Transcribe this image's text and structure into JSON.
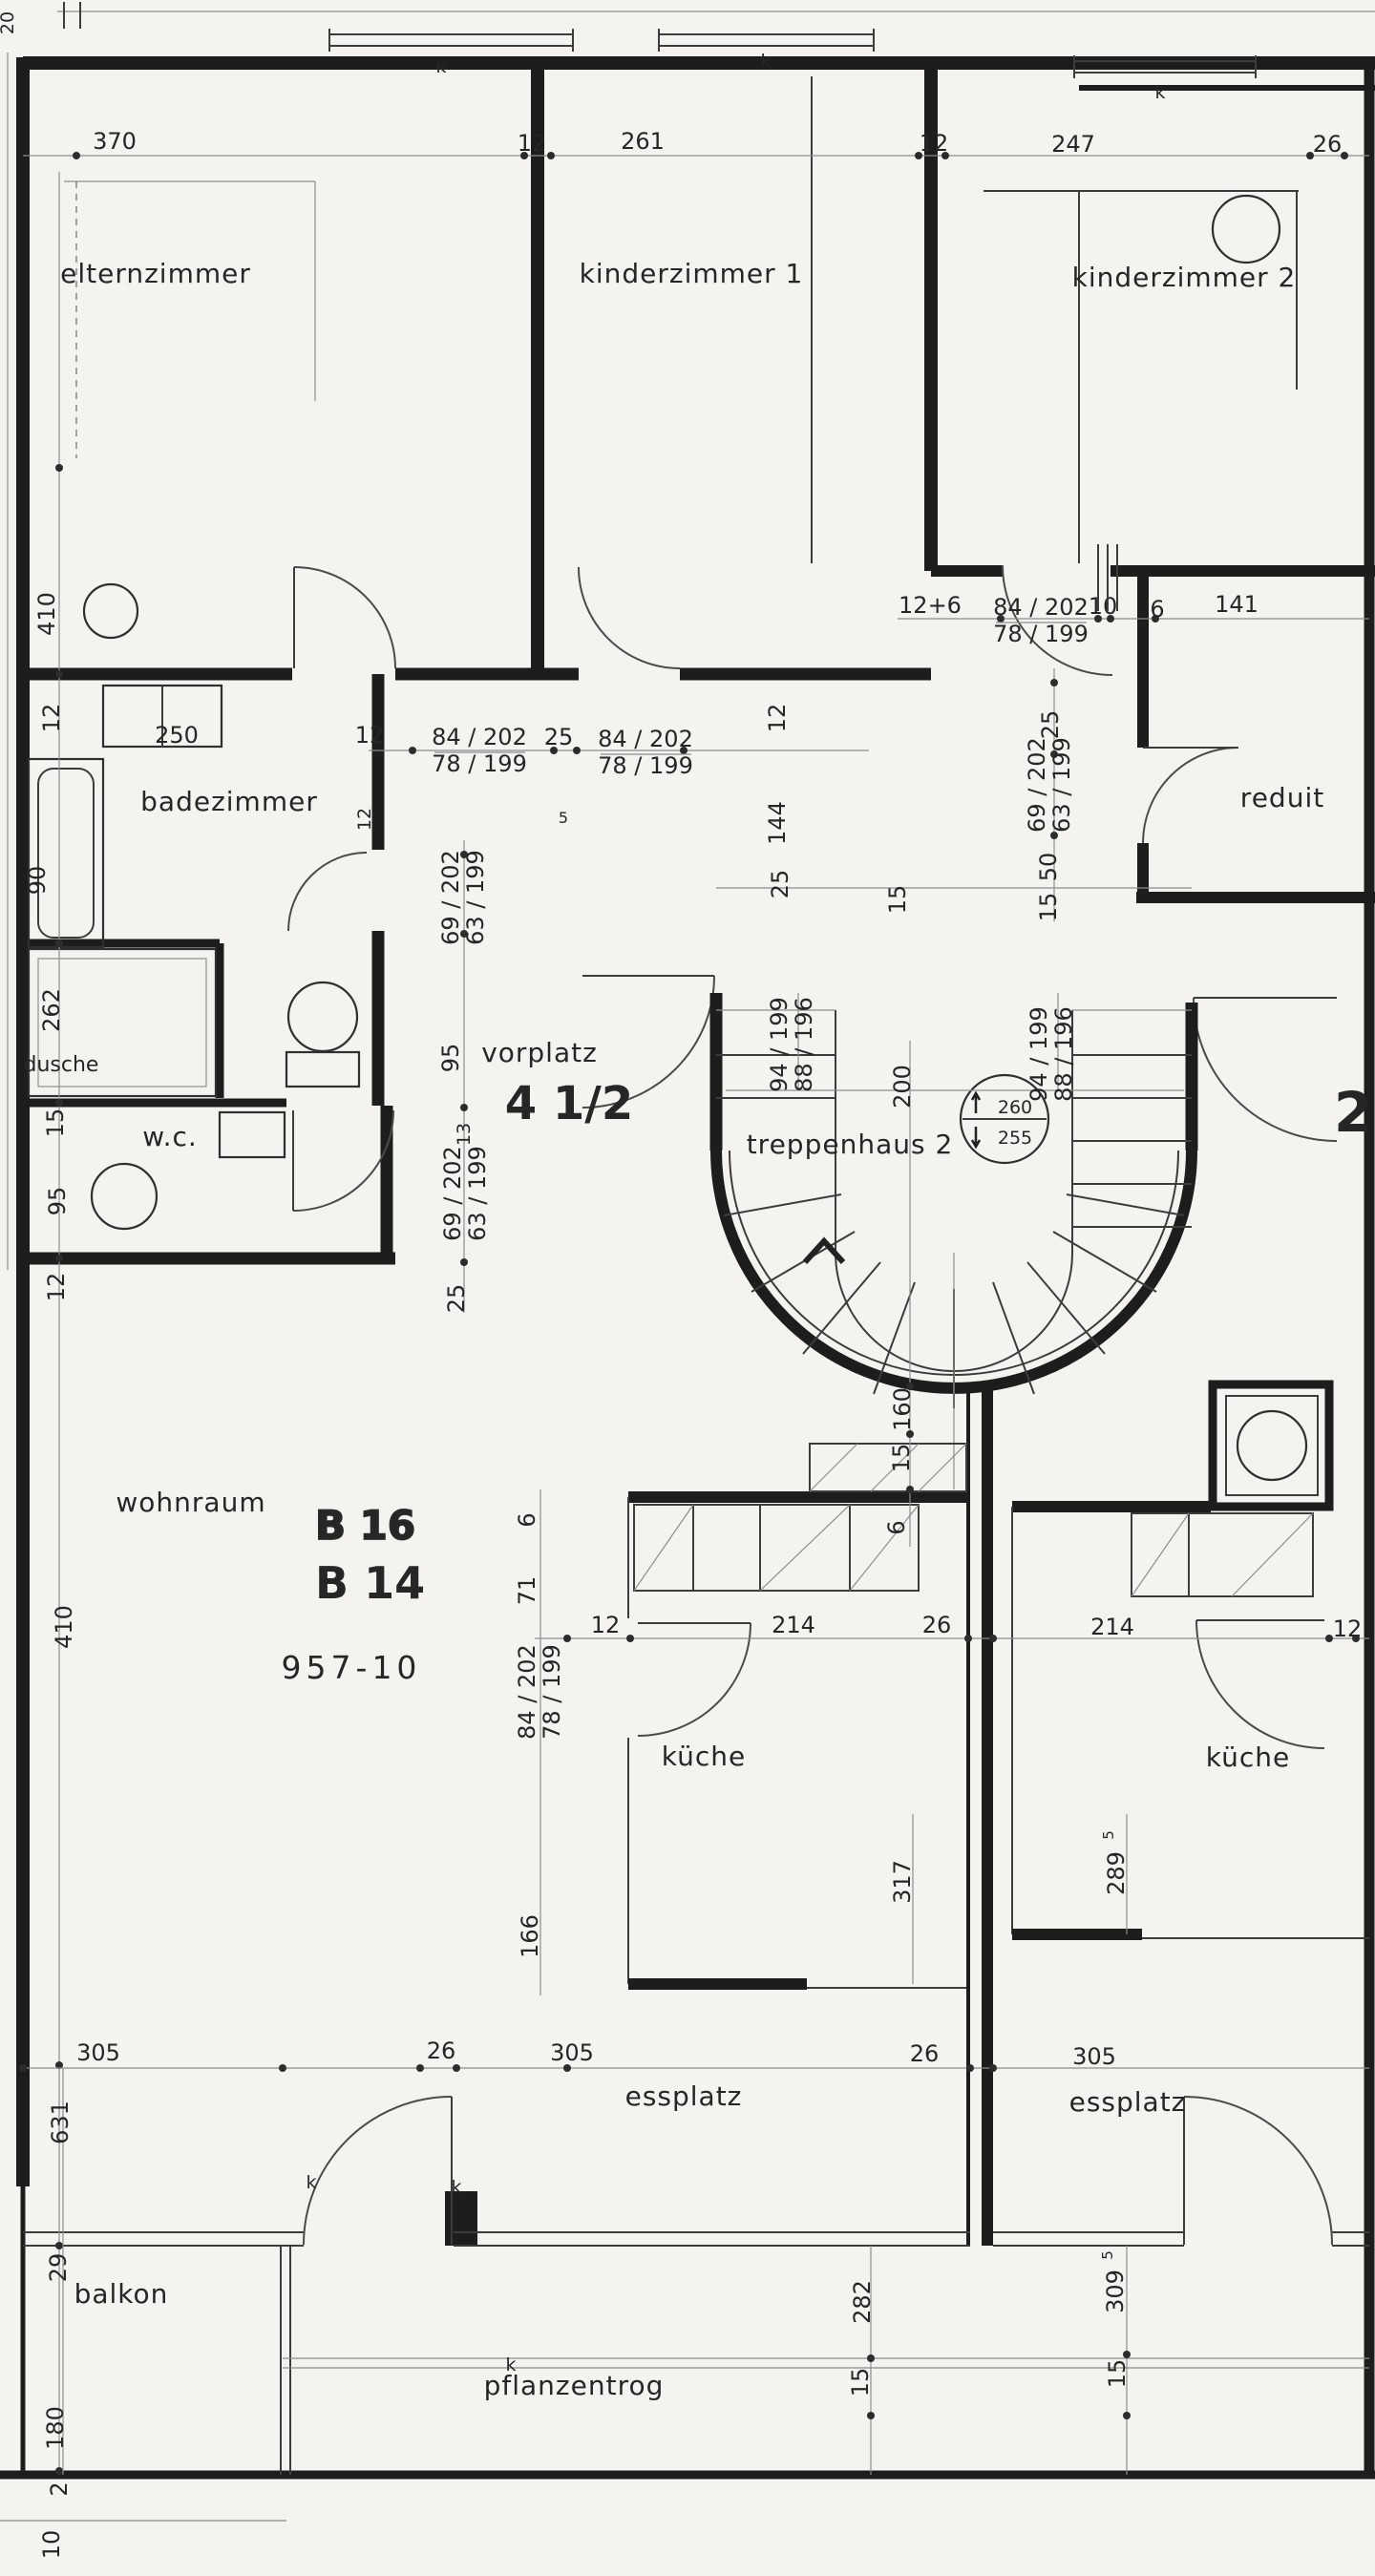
{
  "labels": {
    "rooms": {
      "elternzimmer": "elternzimmer",
      "kinderzimmer1": "kinderzimmer 1",
      "kinderzimmer2": "kinderzimmer 2",
      "badezimmer": "badezimmer",
      "dusche": "dusche",
      "wc": "w.c.",
      "vorplatz": "vorplatz",
      "treppenhaus": "treppenhaus 2",
      "reduit": "reduit",
      "wohnraum": "wohnraum",
      "kueche": "küche",
      "essplatz": "essplatz",
      "balkon": "balkon",
      "pflanzentrog": "pflanzentrog"
    },
    "unit": {
      "size": "4 1/2",
      "b16": "B 16",
      "b14": "B 14",
      "sheet": "957-10",
      "right_unit": "2"
    },
    "levels": {
      "upper": "260",
      "lower": "255"
    },
    "window_mark": "k",
    "doors": {
      "a": "84 / 202",
      "b": "78 / 199",
      "c": "69 / 202",
      "d": "63 / 199",
      "e": "94 / 199",
      "f": "88 / 196"
    },
    "dims": {
      "n20": "20",
      "n370": "370",
      "n12": "12",
      "n261": "261",
      "n247": "247",
      "n26": "26",
      "n410": "410",
      "n250": "250",
      "n90": "90",
      "n262": "262",
      "n15": "15",
      "n95": "95",
      "n25": "25",
      "n5": "5",
      "n144": "144",
      "n12p6": "12+6",
      "n10": "10",
      "n6": "6",
      "n141": "141",
      "n200": "200",
      "n13": "13",
      "n50": "50",
      "n71": "71",
      "n214": "214",
      "n166": "166",
      "n317": "317",
      "n289": "289",
      "n305": "305",
      "n631": "631",
      "n29": "29",
      "n180": "180",
      "n2": "2",
      "n282": "282",
      "n309": "309",
      "n160": "160",
      "sup5": "5"
    }
  }
}
